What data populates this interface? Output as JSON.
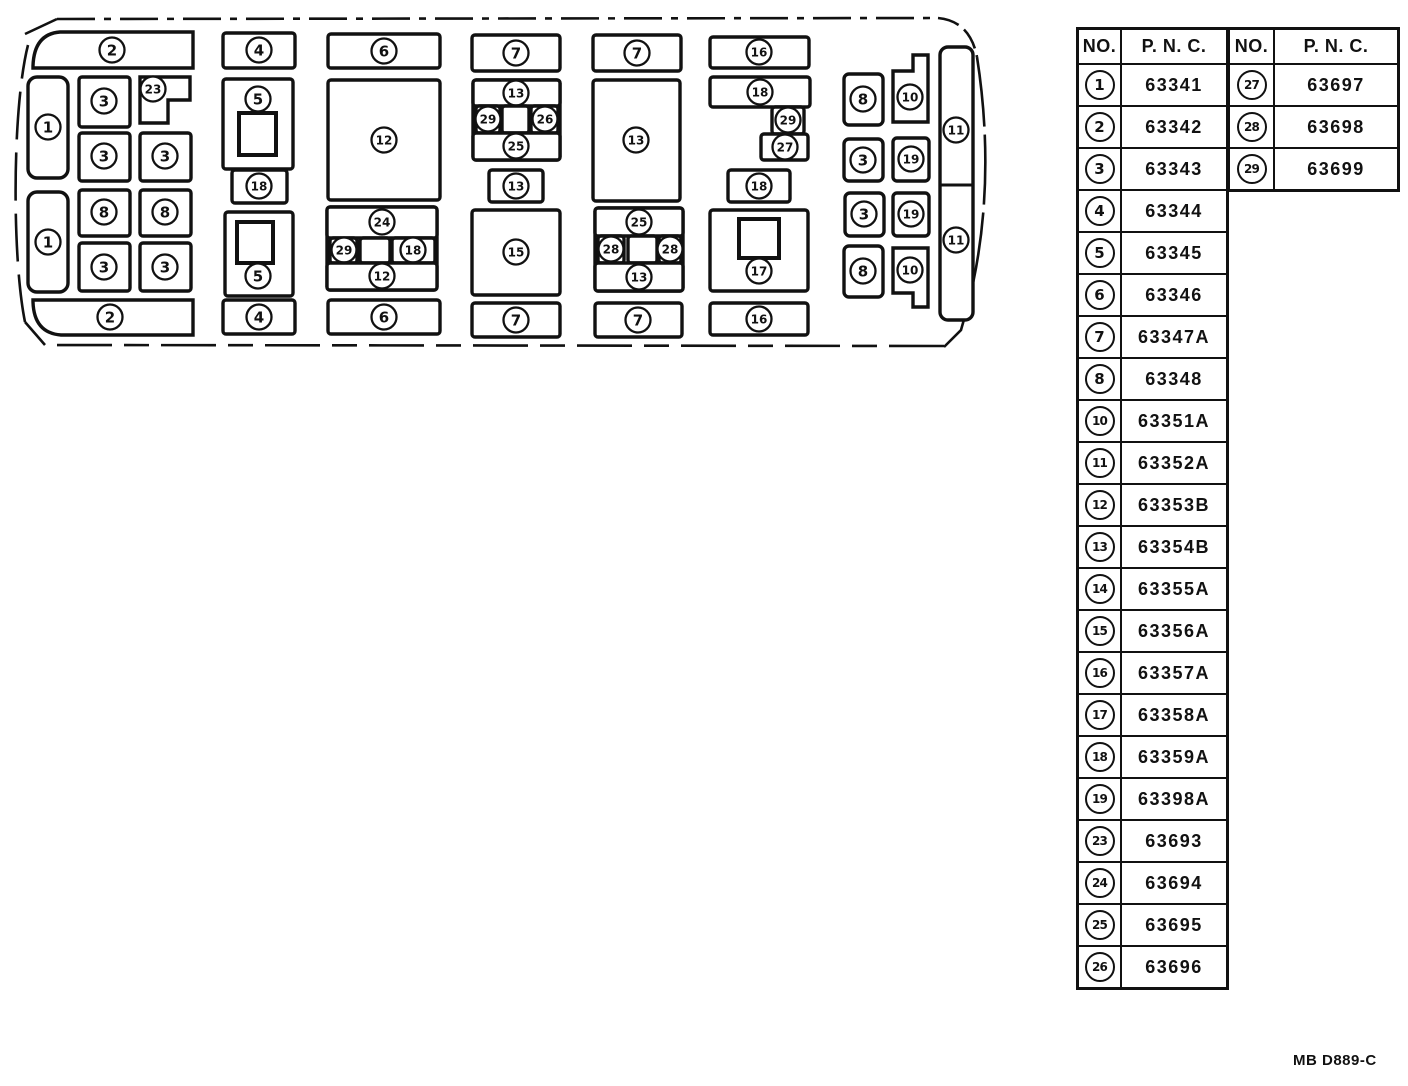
{
  "footer": {
    "code": "MB D889-C"
  },
  "table_left": {
    "headers": {
      "no": "NO.",
      "pnc": "P. N. C."
    },
    "rows": [
      {
        "no": "1",
        "pnc": "63341"
      },
      {
        "no": "2",
        "pnc": "63342"
      },
      {
        "no": "3",
        "pnc": "63343"
      },
      {
        "no": "4",
        "pnc": "63344"
      },
      {
        "no": "5",
        "pnc": "63345"
      },
      {
        "no": "6",
        "pnc": "63346"
      },
      {
        "no": "7",
        "pnc": "63347A"
      },
      {
        "no": "8",
        "pnc": "63348"
      },
      {
        "no": "10",
        "pnc": "63351A"
      },
      {
        "no": "11",
        "pnc": "63352A"
      },
      {
        "no": "12",
        "pnc": "63353B"
      },
      {
        "no": "13",
        "pnc": "63354B"
      },
      {
        "no": "14",
        "pnc": "63355A"
      },
      {
        "no": "15",
        "pnc": "63356A"
      },
      {
        "no": "16",
        "pnc": "63357A"
      },
      {
        "no": "17",
        "pnc": "63358A"
      },
      {
        "no": "18",
        "pnc": "63359A"
      },
      {
        "no": "19",
        "pnc": "63398A"
      },
      {
        "no": "23",
        "pnc": "63693"
      },
      {
        "no": "24",
        "pnc": "63694"
      },
      {
        "no": "25",
        "pnc": "63695"
      },
      {
        "no": "26",
        "pnc": "63696"
      }
    ]
  },
  "table_right": {
    "headers": {
      "no": "NO.",
      "pnc": "P. N. C."
    },
    "rows": [
      {
        "no": "27",
        "pnc": "63697"
      },
      {
        "no": "28",
        "pnc": "63698"
      },
      {
        "no": "29",
        "pnc": "63699"
      }
    ]
  },
  "diagram": {
    "boxes": [
      {
        "shape": "path",
        "d": "M193,32 L60,32 Q34,34 33,66 L33,68 L193,68 Z",
        "label": "2",
        "lx": 112,
        "ly": 50
      },
      {
        "shape": "rect",
        "x": 28,
        "y": 77,
        "w": 40,
        "h": 101,
        "rx": 9,
        "label": "1",
        "lx": 48,
        "ly": 127
      },
      {
        "shape": "rect",
        "x": 28,
        "y": 192,
        "w": 40,
        "h": 100,
        "rx": 9,
        "label": "1",
        "lx": 48,
        "ly": 242
      },
      {
        "shape": "rect",
        "x": 79,
        "y": 77,
        "w": 51,
        "h": 50,
        "label": "3",
        "lx": 104,
        "ly": 101
      },
      {
        "shape": "path",
        "d": "M140,77 L190,77 L190,100 L168,100 L168,123 L140,123 Z",
        "label": "23",
        "lx": 153,
        "ly": 89
      },
      {
        "shape": "rect",
        "x": 79,
        "y": 133,
        "w": 51,
        "h": 48,
        "label": "3",
        "lx": 104,
        "ly": 156
      },
      {
        "shape": "rect",
        "x": 140,
        "y": 133,
        "w": 51,
        "h": 48,
        "label": "3",
        "lx": 165,
        "ly": 156
      },
      {
        "shape": "rect",
        "x": 79,
        "y": 190,
        "w": 51,
        "h": 46,
        "label": "8",
        "lx": 104,
        "ly": 212
      },
      {
        "shape": "rect",
        "x": 140,
        "y": 190,
        "w": 51,
        "h": 46,
        "label": "8",
        "lx": 165,
        "ly": 212
      },
      {
        "shape": "rect",
        "x": 79,
        "y": 243,
        "w": 51,
        "h": 48,
        "label": "3",
        "lx": 104,
        "ly": 267
      },
      {
        "shape": "rect",
        "x": 140,
        "y": 243,
        "w": 51,
        "h": 48,
        "label": "3",
        "lx": 165,
        "ly": 267
      },
      {
        "shape": "path",
        "d": "M193,300 L33,300 L33,302 Q34,333 61,335 L193,335 Z",
        "label": "2",
        "lx": 110,
        "ly": 317
      },
      {
        "shape": "rect",
        "x": 223,
        "y": 33,
        "w": 72,
        "h": 35,
        "label": "4",
        "lx": 259,
        "ly": 50
      },
      {
        "shape": "rect",
        "x": 223,
        "y": 79,
        "w": 70,
        "h": 90,
        "label": "5",
        "lx": 258,
        "ly": 99,
        "inner": [
          239,
          113,
          37,
          42
        ]
      },
      {
        "shape": "rect",
        "x": 232,
        "y": 170,
        "w": 55,
        "h": 33,
        "label": "18",
        "lx": 259,
        "ly": 186
      },
      {
        "shape": "rect",
        "x": 225,
        "y": 212,
        "w": 68,
        "h": 84,
        "label": "5",
        "lx": 258,
        "ly": 276,
        "inner": [
          237,
          222,
          36,
          41
        ]
      },
      {
        "shape": "rect",
        "x": 223,
        "y": 300,
        "w": 72,
        "h": 34,
        "label": "4",
        "lx": 259,
        "ly": 317
      },
      {
        "shape": "rect",
        "x": 328,
        "y": 34,
        "w": 112,
        "h": 34,
        "label": "6",
        "lx": 384,
        "ly": 51
      },
      {
        "shape": "rect",
        "x": 328,
        "y": 80,
        "w": 112,
        "h": 120,
        "label": "12",
        "lx": 384,
        "ly": 140
      },
      {
        "shape": "rect",
        "x": 327,
        "y": 207,
        "w": 110,
        "h": 83
      },
      {
        "shape": "rect",
        "x": 327,
        "y": 207,
        "w": 110,
        "h": 31,
        "label": "24",
        "lx": 382,
        "ly": 222
      },
      {
        "shape": "rect",
        "x": 330,
        "y": 238,
        "w": 27,
        "h": 25,
        "label": "29",
        "lx": 344,
        "ly": 250
      },
      {
        "shape": "rect",
        "x": 360,
        "y": 238,
        "w": 30,
        "h": 25
      },
      {
        "shape": "rect",
        "x": 392,
        "y": 238,
        "w": 43,
        "h": 25,
        "label": "18",
        "lx": 413,
        "ly": 250
      },
      {
        "shape": "rect",
        "x": 327,
        "y": 263,
        "w": 110,
        "h": 27,
        "label": "12",
        "lx": 382,
        "ly": 276
      },
      {
        "shape": "rect",
        "x": 328,
        "y": 300,
        "w": 112,
        "h": 34,
        "label": "6",
        "lx": 384,
        "ly": 317
      },
      {
        "shape": "rect",
        "x": 472,
        "y": 35,
        "w": 88,
        "h": 36,
        "label": "7",
        "lx": 516,
        "ly": 53
      },
      {
        "shape": "rect",
        "x": 473,
        "y": 80,
        "w": 87,
        "h": 80
      },
      {
        "shape": "rect",
        "x": 473,
        "y": 80,
        "w": 87,
        "h": 26,
        "label": "13",
        "lx": 516,
        "ly": 93
      },
      {
        "shape": "rect",
        "x": 476,
        "y": 106,
        "w": 24,
        "h": 27,
        "label": "29",
        "lx": 488,
        "ly": 119
      },
      {
        "shape": "rect",
        "x": 502,
        "y": 106,
        "w": 27,
        "h": 27
      },
      {
        "shape": "rect",
        "x": 531,
        "y": 106,
        "w": 27,
        "h": 27,
        "label": "26",
        "lx": 545,
        "ly": 119
      },
      {
        "shape": "rect",
        "x": 473,
        "y": 133,
        "w": 87,
        "h": 27,
        "label": "25",
        "lx": 516,
        "ly": 146
      },
      {
        "shape": "rect",
        "x": 489,
        "y": 170,
        "w": 54,
        "h": 32,
        "label": "13",
        "lx": 516,
        "ly": 186
      },
      {
        "shape": "rect",
        "x": 472,
        "y": 210,
        "w": 88,
        "h": 85,
        "label": "15",
        "lx": 516,
        "ly": 252
      },
      {
        "shape": "rect",
        "x": 472,
        "y": 303,
        "w": 88,
        "h": 34,
        "label": "7",
        "lx": 516,
        "ly": 320
      },
      {
        "shape": "rect",
        "x": 593,
        "y": 35,
        "w": 88,
        "h": 36,
        "label": "7",
        "lx": 637,
        "ly": 53
      },
      {
        "shape": "rect",
        "x": 593,
        "y": 80,
        "w": 87,
        "h": 121,
        "label": "13",
        "lx": 636,
        "ly": 140
      },
      {
        "shape": "rect",
        "x": 595,
        "y": 208,
        "w": 88,
        "h": 83
      },
      {
        "shape": "rect",
        "x": 595,
        "y": 208,
        "w": 88,
        "h": 28,
        "label": "25",
        "lx": 639,
        "ly": 222
      },
      {
        "shape": "rect",
        "x": 598,
        "y": 236,
        "w": 26,
        "h": 27,
        "label": "28",
        "lx": 611,
        "ly": 249
      },
      {
        "shape": "rect",
        "x": 628,
        "y": 236,
        "w": 29,
        "h": 27
      },
      {
        "shape": "rect",
        "x": 659,
        "y": 236,
        "w": 22,
        "h": 27,
        "label": "28",
        "lx": 670,
        "ly": 249
      },
      {
        "shape": "rect",
        "x": 595,
        "y": 263,
        "w": 88,
        "h": 28,
        "label": "13",
        "lx": 639,
        "ly": 277
      },
      {
        "shape": "rect",
        "x": 595,
        "y": 303,
        "w": 87,
        "h": 34,
        "label": "7",
        "lx": 638,
        "ly": 320
      },
      {
        "shape": "rect",
        "x": 710,
        "y": 37,
        "w": 99,
        "h": 31,
        "label": "16",
        "lx": 759,
        "ly": 52
      },
      {
        "shape": "rect",
        "x": 710,
        "y": 77,
        "w": 100,
        "h": 30,
        "label": "18",
        "lx": 760,
        "ly": 92
      },
      {
        "shape": "rect",
        "x": 772,
        "y": 107,
        "w": 32,
        "h": 27,
        "label": "29",
        "lx": 788,
        "ly": 120
      },
      {
        "shape": "rect",
        "x": 761,
        "y": 134,
        "w": 47,
        "h": 26,
        "label": "27",
        "lx": 785,
        "ly": 147
      },
      {
        "shape": "rect",
        "x": 728,
        "y": 170,
        "w": 62,
        "h": 32,
        "label": "18",
        "lx": 759,
        "ly": 186
      },
      {
        "shape": "rect",
        "x": 710,
        "y": 210,
        "w": 98,
        "h": 81,
        "label": "17",
        "lx": 759,
        "ly": 271,
        "inner": [
          739,
          219,
          40,
          39
        ]
      },
      {
        "shape": "rect",
        "x": 710,
        "y": 303,
        "w": 98,
        "h": 32,
        "label": "16",
        "lx": 759,
        "ly": 319
      },
      {
        "shape": "rect",
        "x": 844,
        "y": 74,
        "w": 39,
        "h": 51,
        "rx": 5,
        "label": "8",
        "lx": 863,
        "ly": 99
      },
      {
        "shape": "path",
        "d": "M913,55 L928,55 L928,122 L893,122 L893,71 L913,71 Z",
        "label": "10",
        "lx": 910,
        "ly": 97
      },
      {
        "shape": "rect",
        "x": 844,
        "y": 139,
        "w": 39,
        "h": 42,
        "rx": 5,
        "label": "3",
        "lx": 863,
        "ly": 160
      },
      {
        "shape": "rect",
        "x": 893,
        "y": 138,
        "w": 36,
        "h": 43,
        "rx": 4,
        "label": "19",
        "lx": 911,
        "ly": 159
      },
      {
        "shape": "rect",
        "x": 845,
        "y": 193,
        "w": 39,
        "h": 43,
        "rx": 5,
        "label": "3",
        "lx": 864,
        "ly": 214
      },
      {
        "shape": "rect",
        "x": 893,
        "y": 193,
        "w": 36,
        "h": 43,
        "rx": 4,
        "label": "19",
        "lx": 911,
        "ly": 214
      },
      {
        "shape": "rect",
        "x": 844,
        "y": 246,
        "w": 39,
        "h": 51,
        "rx": 5,
        "label": "8",
        "lx": 863,
        "ly": 271
      },
      {
        "shape": "path",
        "d": "M893,248 L928,248 L928,307 L913,307 L913,293 L893,293 Z",
        "label": "10",
        "lx": 910,
        "ly": 270
      },
      {
        "shape": "rect",
        "x": 940,
        "y": 47,
        "w": 33,
        "h": 273,
        "rx": 8
      },
      {
        "shape": "line",
        "d": "M940,185 L973,185"
      },
      {
        "shape": "none",
        "label": "11",
        "lx": 956,
        "ly": 130
      },
      {
        "shape": "none",
        "label": "11",
        "lx": 956,
        "ly": 240
      }
    ]
  }
}
